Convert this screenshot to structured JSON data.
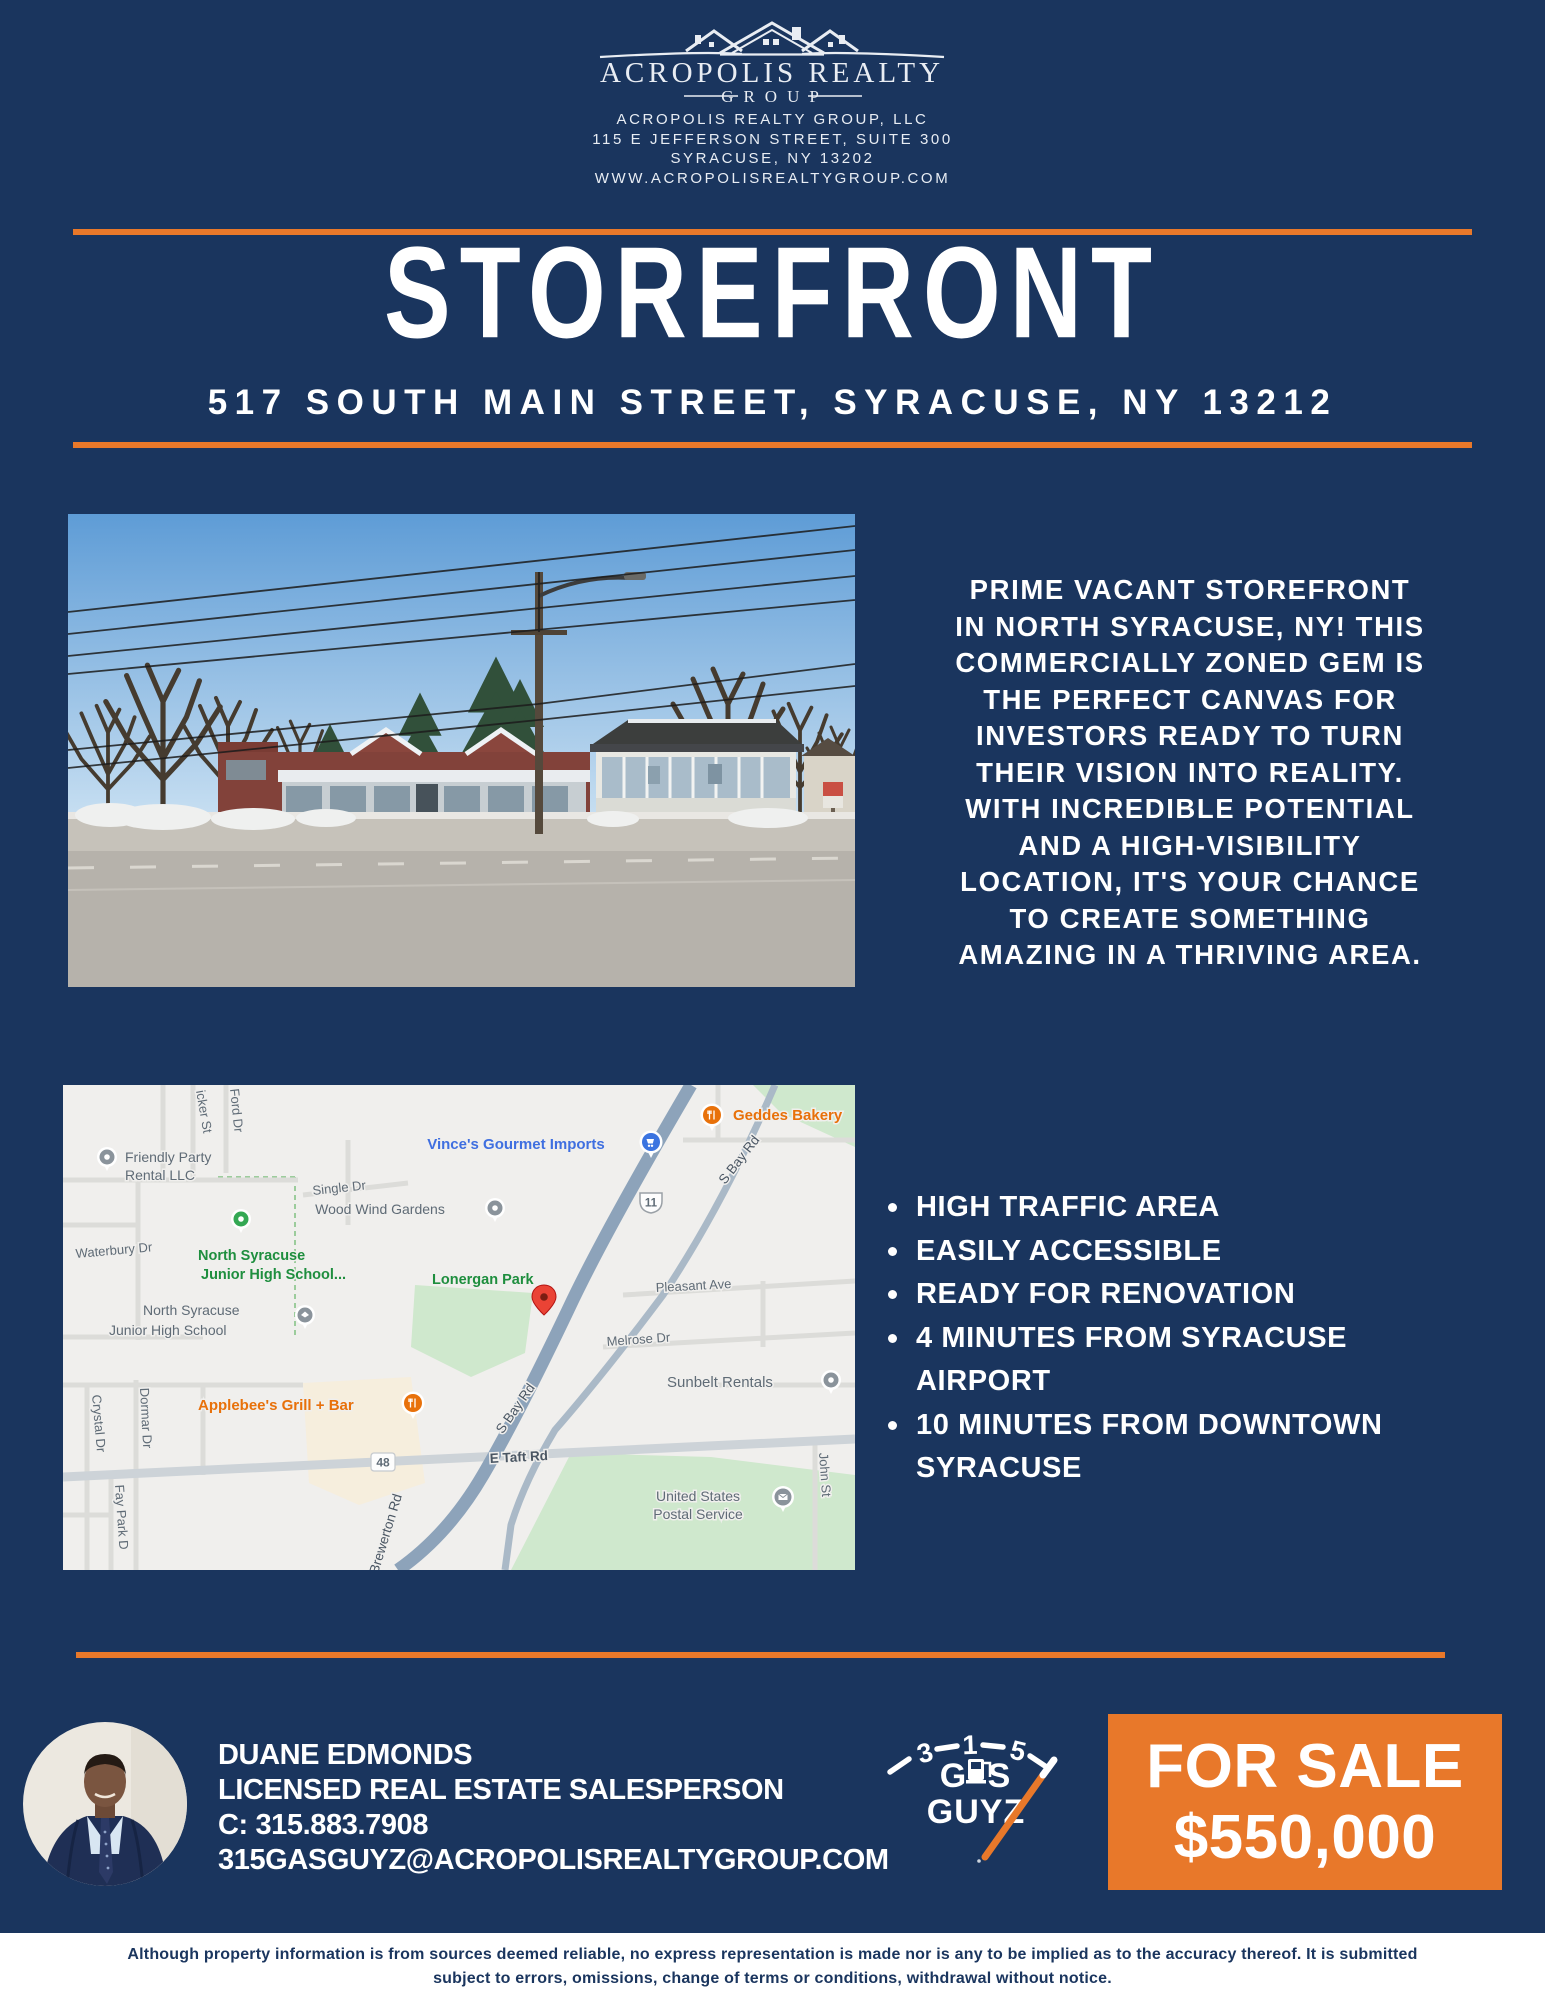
{
  "colors": {
    "navy": "#1a355e",
    "orange": "#e8782a",
    "white": "#ffffff"
  },
  "header": {
    "brand_name": "ACROPOLIS REALTY",
    "brand_sub": "GROUP",
    "lines": [
      "ACROPOLIS REALTY GROUP, LLC",
      "115 E JEFFERSON STREET, SUITE 300",
      "SYRACUSE, NY 13202",
      "WWW.ACROPOLISREALTYGROUP.COM"
    ]
  },
  "hero": {
    "title": "STOREFRONT",
    "address": "517 SOUTH MAIN STREET, SYRACUSE, NY 13212"
  },
  "description_lines": [
    "PRIME VACANT STOREFRONT",
    "IN NORTH SYRACUSE, NY! THIS",
    "COMMERCIALLY ZONED GEM IS",
    "THE PERFECT CANVAS FOR",
    "INVESTORS READY TO TURN",
    "THEIR VISION INTO REALITY.",
    "WITH INCREDIBLE POTENTIAL",
    "AND A HIGH-VISIBILITY",
    "LOCATION, IT'S YOUR CHANCE",
    "TO CREATE SOMETHING",
    "AMAZING IN A THRIVING AREA."
  ],
  "features": [
    "HIGH TRAFFIC AREA",
    "EASILY ACCESSIBLE",
    "READY FOR RENOVATION",
    "4 MINUTES FROM SYRACUSE AIRPORT",
    "10 MINUTES FROM DOWNTOWN SYRACUSE"
  ],
  "map": {
    "labels": {
      "friendly1": "Friendly Party",
      "friendly2": "Rental LLC",
      "icker": "icker St",
      "ford": "Ford Dr",
      "single": "Single Dr",
      "vinces": "Vince's Gourmet Imports",
      "geddes": "Geddes Bakery",
      "sbay1": "S Bay Rd",
      "route11": "11",
      "woodwind": "Wood Wind Gardens",
      "waterbury": "Waterbury Dr",
      "nsjhs1a": "North Syracuse",
      "nsjhs1b": "Junior High School...",
      "lonergan": "Lonergan Park",
      "pleasant": "Pleasant Ave",
      "nsjhs2a": "North Syracuse",
      "nsjhs2b": "Junior High School",
      "melrose": "Melrose Dr",
      "sunbelt": "Sunbelt Rentals",
      "applebees": "Applebee's Grill + Bar",
      "crystal": "Crystal Dr",
      "dormar": "Dormar Dr",
      "route48": "48",
      "etaft": "E Taft Rd",
      "sbay2": "S Bay Rd",
      "brewerton": "Brewerton Rd",
      "usps1": "United States",
      "usps2": "Postal Service",
      "john": "John St",
      "faypark": "Fay Park D"
    }
  },
  "agent": {
    "name": "DUANE EDMONDS",
    "title": "LICENSED REAL ESTATE SALESPERSON",
    "phone": "C: 315.883.7908",
    "email": "315GASGUYZ@ACROPOLISREALTYGROUP.COM"
  },
  "gauge": {
    "n3": "3",
    "n1": "1",
    "n5": "5",
    "gas_left": "G",
    "gas_right": "S",
    "guyz": "GUYZ"
  },
  "sale": {
    "line1": "FOR SALE",
    "line2": "$550,000"
  },
  "footer_lines": [
    "Although property information is from sources deemed reliable, no express representation is made nor is any to be implied as to the accuracy thereof. It is submitted",
    "subject to errors, omissions, change of terms or conditions, withdrawal without notice."
  ]
}
